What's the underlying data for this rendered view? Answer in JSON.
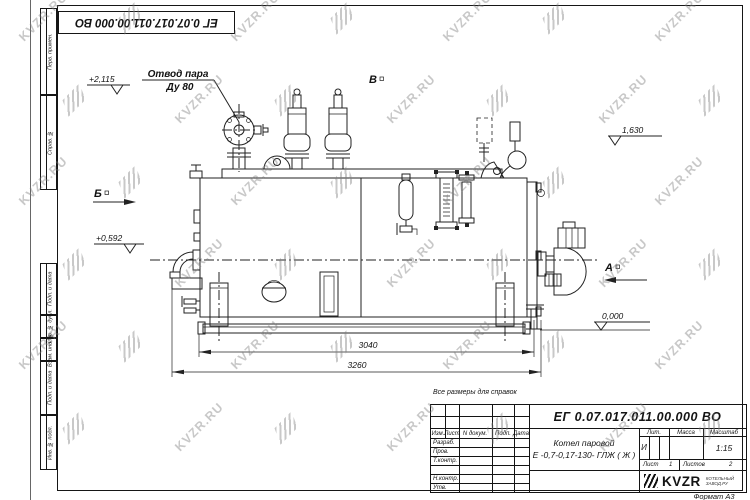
{
  "watermark": {
    "text": "KVZR.RU"
  },
  "stamp_top": "ЕГ 0.07.017.011.00.000  ВО",
  "margin_labels": {
    "perv_primen": "Перв. примен.",
    "sprav_no": "Справ. №",
    "podp_data_1": "Подп. и дата",
    "inv_dubl": "Инв. № дубл.",
    "vzam_inv": "Взам. инв. №",
    "podp_data_2": "Подп. и дата",
    "inv_podl": "Инв. № подл."
  },
  "drawing": {
    "labels": {
      "steam_outlet_line1": "Отвод пара",
      "steam_outlet_line2": "Ду 80",
      "view_a": "А",
      "view_b": "Б",
      "view_v": "В",
      "elev_top": "+2,115",
      "elev_mid": "+0,592",
      "elev_right": "1,630",
      "elev_zero": "0,000",
      "dim_inner": "3040",
      "dim_outer": "3260"
    }
  },
  "note": "Все размеры для справок",
  "title_block": {
    "doc_number": "ЕГ 0.07.017.011.00.000  ВО",
    "product_name_line1": "Котел паровой",
    "product_name_line2": "Е -0,7-0,17-130- ГЛЖ ( Ж )",
    "header_izm": "Изм.",
    "header_list": "Лист",
    "header_docum": "N докум.",
    "header_podp": "Подп.",
    "header_data": "Дата",
    "rows": [
      "Разраб.",
      "Пров.",
      "Т.контр.",
      "Н.контр.",
      "Утв."
    ],
    "lit_header": "Лит.",
    "mass_header": "Масса",
    "scale_header": "Масштаб",
    "lit_value": "И",
    "scale_value": "1:15",
    "sheet_label": "Лист",
    "sheet_value": "1",
    "sheets_label": "Листов",
    "sheets_value": "2",
    "logo_text": "KVZR",
    "logo_sub1": "КОТЕЛЬНЫЙ",
    "logo_sub2": "ЗАВОД.РУ",
    "format_label": "Формат А3"
  }
}
